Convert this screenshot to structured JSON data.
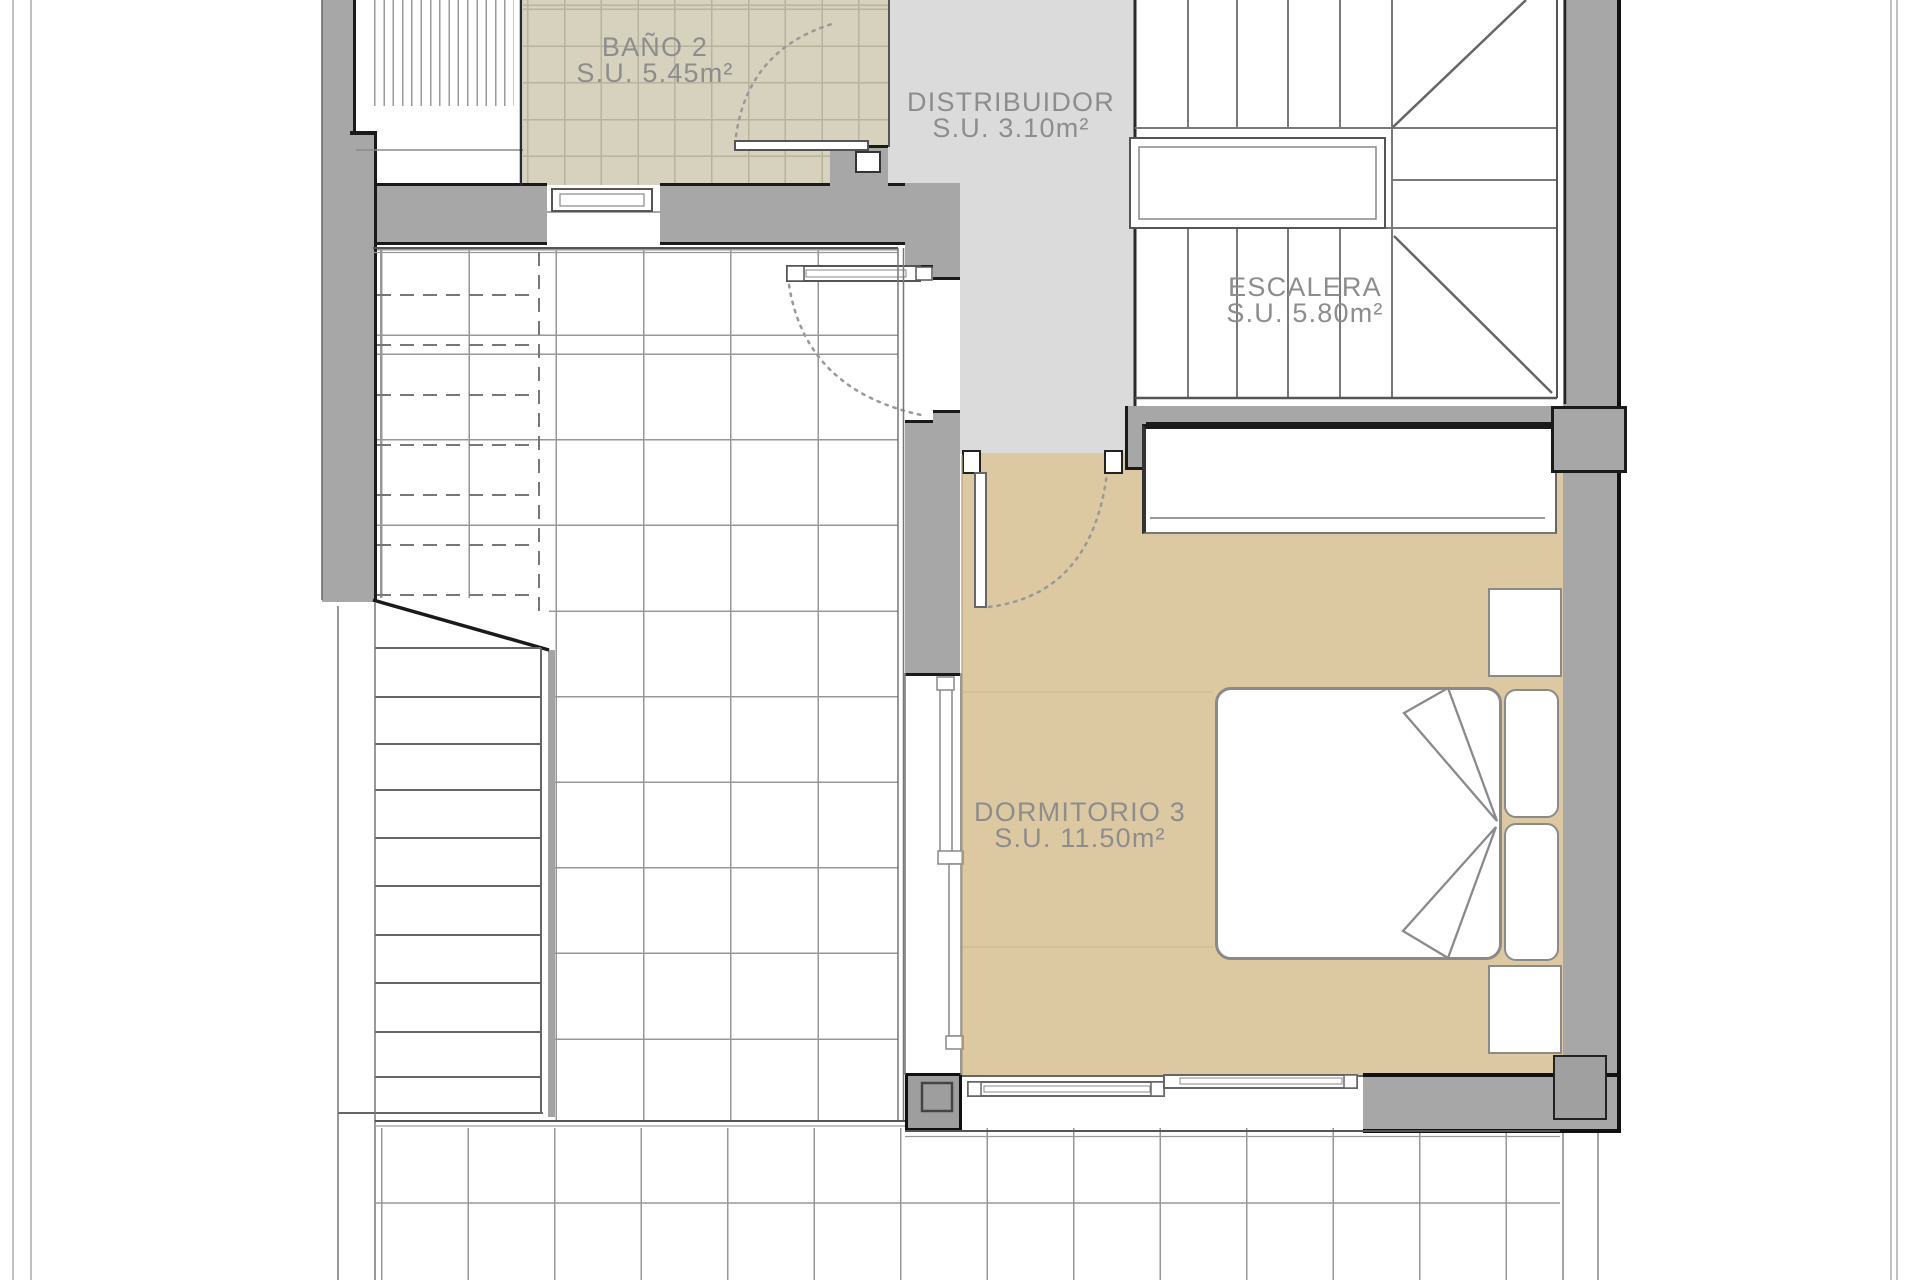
{
  "plan": {
    "type": "floor-plan",
    "rooms": [
      {
        "id": "bano2",
        "name": "BAÑO 2",
        "area": "S.U. 5.45m²"
      },
      {
        "id": "distribuidor",
        "name": "DISTRIBUIDOR",
        "area": "S.U. 3.10m²"
      },
      {
        "id": "escalera",
        "name": "ESCALERA",
        "area": "S.U. 5.80m²"
      },
      {
        "id": "dormitorio3",
        "name": "DORMITORIO 3",
        "area": "S.U. 11.50m²"
      }
    ],
    "colors": {
      "wall_gray": "#a7a7a7",
      "distribuidor_floor": "#dbdbdb",
      "bath_tile": "#d6d2bd",
      "bedroom_floor": "#dcc9a2",
      "line_dark": "#1a1a1a",
      "label_text": "#8d8d8d"
    }
  }
}
